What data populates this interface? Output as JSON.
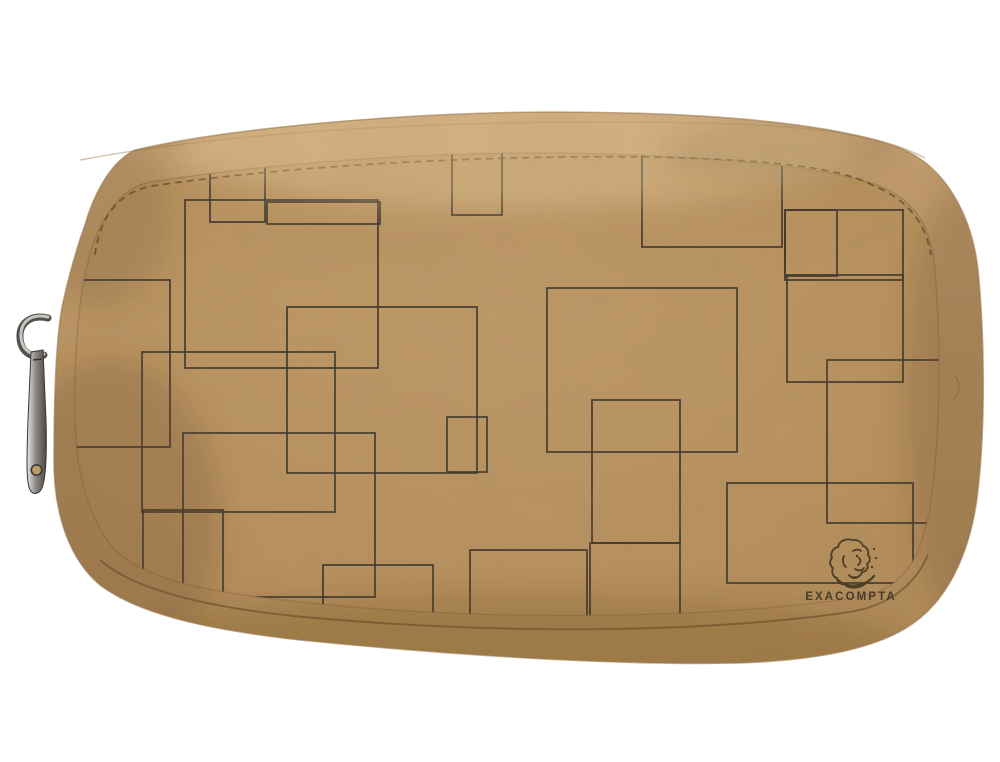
{
  "scene": {
    "type": "product-photo",
    "background_color": "#ffffff",
    "product": {
      "kind": "kraft-paper zipper pouch",
      "brand_text": "EXACOMPTA",
      "logo_icon": "sketched-head-icon",
      "colors": {
        "body_top": "#c7a172",
        "body_mid": "#bb9463",
        "body_bottom": "#b08a57",
        "panel_center": "#c09a69",
        "panel_edge": "#b18a58",
        "pattern_line": "#3a332c",
        "stitch": "#6a4f2d",
        "piping": "#7d5c35",
        "logo_ink": "#42361f",
        "metal_light": "#e8e6e3",
        "metal_dark": "#4b4744"
      },
      "pattern": {
        "style": "overlapping-rectangle-outlines",
        "line_color": "#3a332c",
        "rects": [
          [
            185,
            200,
            193,
            168
          ],
          [
            267,
            202,
            113,
            22
          ],
          [
            210,
            120,
            55,
            102
          ],
          [
            20,
            280,
            150,
            167
          ],
          [
            142,
            352,
            193,
            160
          ],
          [
            183,
            433,
            192,
            164
          ],
          [
            143,
            510,
            80,
            93
          ],
          [
            323,
            565,
            110,
            70
          ],
          [
            547,
            288,
            190,
            164
          ],
          [
            642,
            145,
            140,
            102
          ],
          [
            452,
            95,
            50,
            120
          ],
          [
            785,
            210,
            118,
            70
          ],
          [
            785,
            210,
            52,
            66
          ],
          [
            787,
            275,
            116,
            107
          ],
          [
            827,
            360,
            155,
            163
          ],
          [
            727,
            483,
            186,
            100
          ],
          [
            470,
            550,
            117,
            100
          ],
          [
            590,
            543,
            90,
            90
          ],
          [
            287,
            307,
            190,
            166
          ],
          [
            447,
            417,
            40,
            55
          ],
          [
            592,
            400,
            88,
            143
          ]
        ]
      },
      "zipper": {
        "position": "left",
        "parts": [
          "metal-ring",
          "metal-pull-tab"
        ]
      }
    }
  }
}
